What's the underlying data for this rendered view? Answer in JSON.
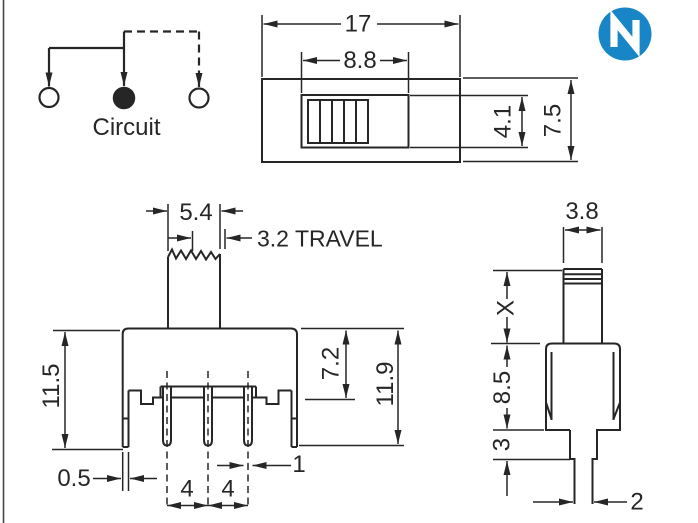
{
  "drawing": {
    "logo": {
      "letter": "N",
      "color": "#1886c6"
    },
    "circuit": {
      "label": "Circuit"
    },
    "top_view": {
      "dims": {
        "overall_width": "17",
        "slot_width": "8.8",
        "slot_height": "4.1",
        "overall_depth": "7.5"
      }
    },
    "front_view": {
      "dims": {
        "knob_width": "5.4",
        "travel": "3.2 TRAVEL",
        "mount_height": "11.5",
        "body_height": "7.2",
        "overall_height": "11.9",
        "bracket_thickness": "0.5",
        "pin_pitch_a": "4",
        "pin_pitch_b": "4",
        "pin_width": "1"
      }
    },
    "side_view": {
      "dims": {
        "knob_depth": "3.8",
        "knob_height": "X",
        "body_depth": "8.5",
        "stub_height": "3",
        "pin_thickness": "2"
      }
    },
    "colors": {
      "line": "#262626",
      "logo_blue": "#1886c6",
      "background": "#ffffff"
    }
  }
}
